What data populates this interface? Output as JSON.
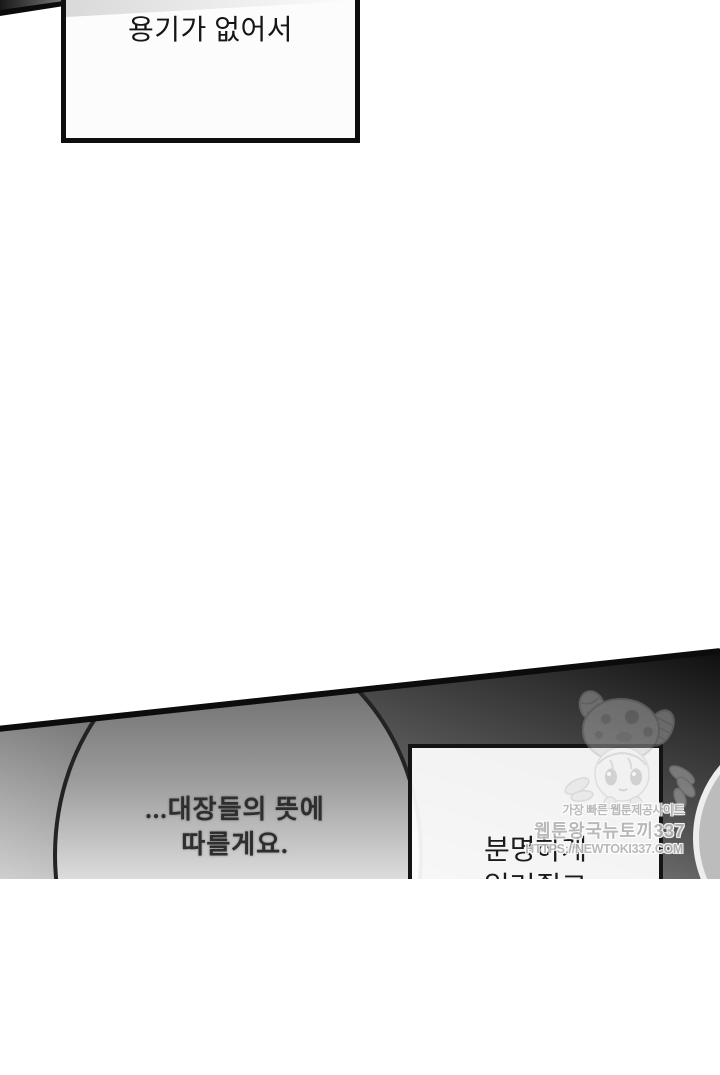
{
  "page": {
    "type": "webtoon-episode-page",
    "width": 720,
    "height": 879,
    "background": "#ffffff"
  },
  "top_panel": {
    "speech_box": {
      "text": "용기가 없어서"
    }
  },
  "bottom_panel": {
    "left_bubble": {
      "lines": [
        "...대장들의 뜻에",
        "따를게요."
      ]
    },
    "right_box": {
      "lines": [
        "분명하게",
        "일러줬고"
      ]
    }
  },
  "watermark": {
    "tagline": "가장 빠른 웹툰제공사이트",
    "site_name": "웹툰왕국뉴토끼337",
    "url": "HTTPS://NEWTOKI337.COM",
    "mascot": "chibi-girl-mascot"
  },
  "colors": {
    "ink": "#0e0e0e",
    "panel_gradient_dark": "#0b0b0b",
    "panel_gradient_light": "#cfcfcf",
    "bubble_fill_light": "#f6f6f6",
    "watermark_gray": "#b5b5b5"
  }
}
